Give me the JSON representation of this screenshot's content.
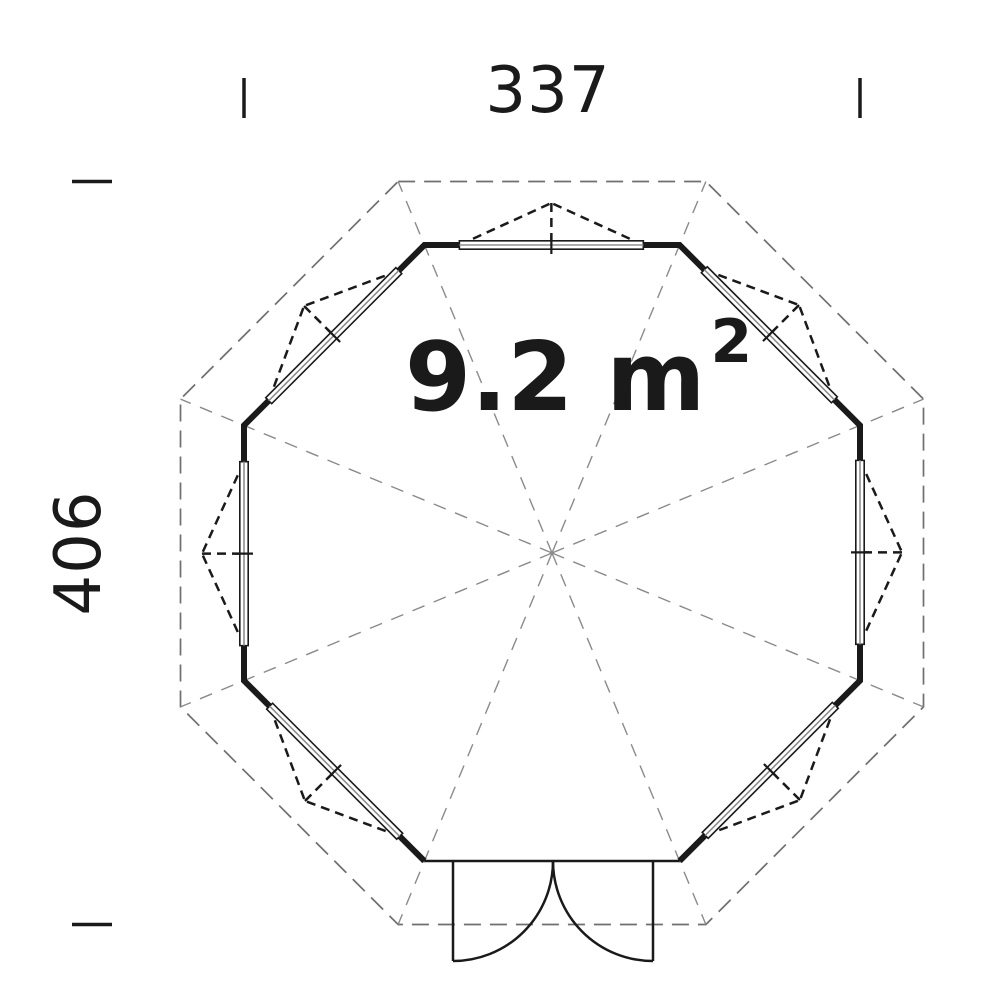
{
  "drawing_type": "floor-plan",
  "labels": {
    "width_dimension": "337",
    "height_dimension": "406",
    "area": {
      "main": "9.2 m",
      "sup": "2"
    }
  },
  "colors": {
    "ink": "#1a1a1a",
    "roof_dash": "#6f6f6f",
    "ridge_dash": "#8a8a8a",
    "window_mid": "#8f8f8f",
    "background": "#ffffff"
  },
  "plan": {
    "center_x": 552,
    "center_y": 553,
    "wall_half_width": 308,
    "roof_half_width": 371.5,
    "wall_stroke": 6,
    "window_span_start": 0.137,
    "window_span_end": 0.858,
    "window_band_half": 4.2,
    "window_tick_half": 9,
    "indicator_depth": 42,
    "sides": [
      {
        "index": 0,
        "name": "top",
        "feature": "window"
      },
      {
        "index": 1,
        "name": "top-right",
        "feature": "window"
      },
      {
        "index": 2,
        "name": "right",
        "feature": "window"
      },
      {
        "index": 3,
        "name": "bottom-right",
        "feature": "window"
      },
      {
        "index": 4,
        "name": "bottom",
        "feature": "door"
      },
      {
        "index": 5,
        "name": "bottom-left",
        "feature": "window"
      },
      {
        "index": 6,
        "name": "left",
        "feature": "window"
      },
      {
        "index": 7,
        "name": "top-left",
        "feature": "window"
      }
    ],
    "door": {
      "jamb_left_x": 453,
      "jamb_right_x": 653,
      "frame_stroke": 2.5
    }
  },
  "dimensions": {
    "top": {
      "tick_x1": 244,
      "tick_x2": 860,
      "tick_y": 78,
      "tick_len": 40,
      "label_x": 548,
      "label_y": 112
    },
    "left": {
      "tick_y1": 181.5,
      "tick_y2": 924.5,
      "tick_x": 72,
      "tick_len": 40,
      "label_x": 100,
      "label_y": 553
    },
    "tick_stroke": 3.5
  },
  "area_text": {
    "x": 405,
    "y": 410,
    "sup_rise": 48
  }
}
